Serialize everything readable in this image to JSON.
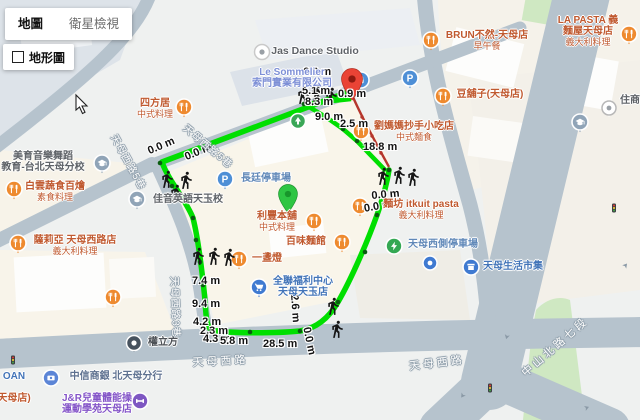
{
  "colors": {
    "route_green": "#00df00",
    "route_red": "#b5362c",
    "pin_red": "#ea4335",
    "pin_green": "#2ec543",
    "poi_orange": "#ee8a2f",
    "poi_blue": "#4684d8",
    "road": "#b6c3cd",
    "park": "#cfe8c2"
  },
  "controls": {
    "map": "地圖",
    "satellite": "衛星檢視",
    "terrain": "地形圖"
  },
  "distances": [
    "6.2 m",
    "5.1 m",
    "0.9 m",
    "8.3 m",
    "9.0 m",
    "2.5 m",
    "18.8 m",
    "0.0 m",
    "0.0 m",
    "0.0 m",
    "0.0 m",
    "7.4 m",
    "9.4 m",
    "4.2 m",
    "2.3 m",
    "4.3 m",
    "5.8 m",
    "28.5 m",
    "2.6 m",
    "0.0 m"
  ],
  "pois": [
    {
      "lines": [
        "Jas Dance Studio"
      ]
    },
    {
      "lines": [
        "Le Sommelier",
        "索門實業有限公司"
      ]
    },
    {
      "lines": [
        "四方居",
        "中式料理"
      ]
    },
    {
      "lines": [
        "美育音樂舞蹈",
        "教育-台北天母分校"
      ]
    },
    {
      "lines": [
        "白雲蔬食百燴",
        "素食料理"
      ]
    },
    {
      "lines": [
        "佳音英語天玉校"
      ]
    },
    {
      "lines": [
        "薩莉亞 天母西路店",
        "義大利料理"
      ]
    },
    {
      "lines": [
        "長廷停車場"
      ]
    },
    {
      "lines": [
        "利豐本舖",
        "中式料理"
      ]
    },
    {
      "lines": [
        "百味麵館"
      ]
    },
    {
      "lines": [
        "一盞燈"
      ]
    },
    {
      "lines": [
        "全聯福利中心",
        "天母天玉店"
      ]
    },
    {
      "lines": [
        "劉媽媽抄手小吃店",
        "中式麵食"
      ]
    },
    {
      "lines": [
        "麵坊 itkuit pasta",
        "義大利料理"
      ]
    },
    {
      "lines": [
        "天母西側停車場"
      ]
    },
    {
      "lines": [
        "天母生活市集"
      ]
    },
    {
      "lines": [
        "BRUN不然-天母店",
        "早午餐"
      ]
    },
    {
      "lines": [
        "LA PASTA 義",
        "麵屋天母店",
        "義大利料理"
      ]
    },
    {
      "lines": [
        "豆舖子(天母店)"
      ]
    },
    {
      "lines": [
        "住商"
      ]
    },
    {
      "lines": [
        "權立方"
      ]
    },
    {
      "lines": [
        "中信商銀 北天母分行"
      ]
    },
    {
      "lines": [
        "J&R兒童體能操",
        "運動學苑天母店"
      ]
    },
    {
      "lines": [
        "OAN"
      ]
    },
    {
      "lines": [
        "天母店)"
      ]
    }
  ],
  "streets": [
    "天母西路",
    "天母西路",
    "中山北路七段",
    "天母西路5巷",
    "天母西路5巷",
    "天母西路3巷"
  ]
}
